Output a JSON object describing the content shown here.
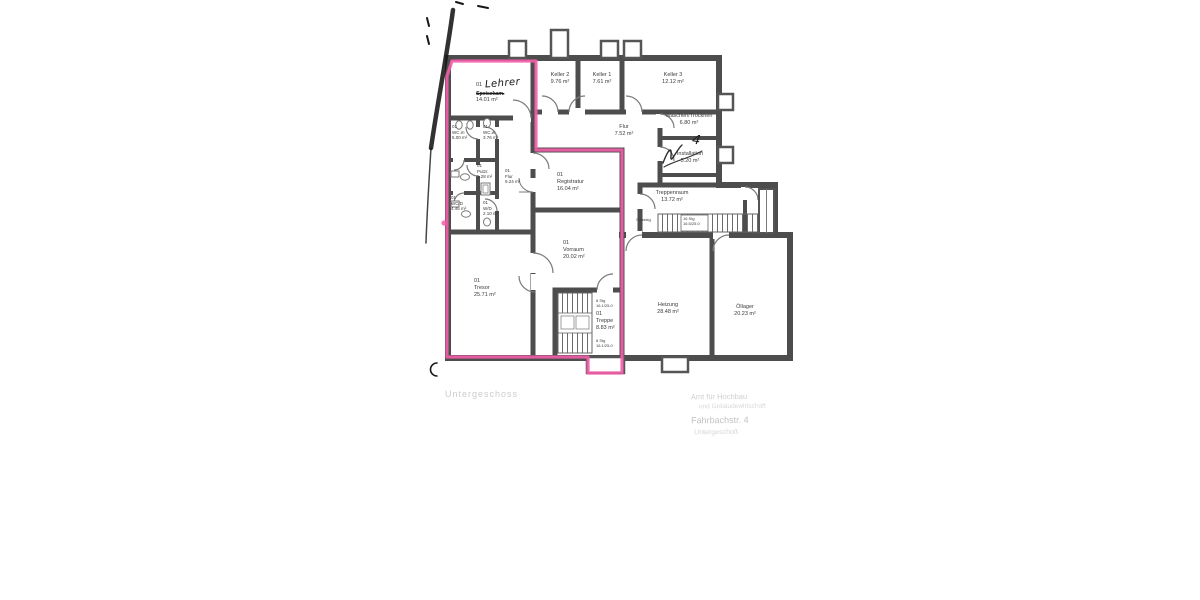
{
  "plan": {
    "floor_note": "Untergeschoss",
    "pen_note": "4"
  },
  "rooms": {
    "lehrer": {
      "num": "01",
      "handwritten": "Lehrer",
      "crossed_out": "Speisekam.",
      "area": "14.01 m²"
    },
    "keller2": {
      "name": "Keller 2",
      "area": "9.76 m²"
    },
    "keller1": {
      "name": "Keller 1",
      "area": "7.61 m²"
    },
    "keller3": {
      "name": "Keller 3",
      "area": "12.12 m²"
    },
    "waschen_trocknen": {
      "name": "Waschen/Trocknen",
      "area": "6.80 m²"
    },
    "flur_og": {
      "name": "Flur",
      "area": "7.52 m²"
    },
    "installation": {
      "name": "Installation",
      "area": "5.20 m²"
    },
    "treppenraum": {
      "name": "Treppenraum",
      "area": "13.72 m²"
    },
    "wc_m": {
      "num": "01",
      "name": "WC.m",
      "area": "5.00 m²"
    },
    "wc_w": {
      "num": "01",
      "name": "WC.w",
      "area": "3.76 m²"
    },
    "putzraum": {
      "num": "01",
      "name": "Putzr.",
      "area": "1.28 m²"
    },
    "flur_klein": {
      "num": "01",
      "name": "Flur",
      "area": "9.24 m²"
    },
    "wc_d": {
      "num": "01",
      "name": "WC/D",
      "area": "4.46 m²"
    },
    "w_d": {
      "num": "01",
      "name": "W/D",
      "area": "2.10 m²"
    },
    "registratur": {
      "num": "01",
      "name": "Registratur",
      "area": "16.04 m²"
    },
    "vorraum": {
      "num": "01",
      "name": "Vorraum",
      "area": "20.02 m²"
    },
    "tresor": {
      "num": "01",
      "name": "Tresor",
      "area": "25.71 m²"
    },
    "treppe": {
      "num": "01",
      "name": "Treppe",
      "area": "8.83 m²"
    },
    "heizung": {
      "name": "Heizung",
      "area": "28.48 m²"
    },
    "oellager": {
      "name": "Öllager",
      "area": "20.23 m²"
    }
  },
  "stair_labels": {
    "treppenraum_steps_line1": "16 Stg",
    "treppenraum_steps_line2": "16.5/25.0",
    "treppenraum_material": "Sandstg.",
    "lower_top_line1": "8 Stg",
    "lower_top_line2": "16.1/25.0",
    "lower_bottom_line1": "8 Stg",
    "lower_bottom_line2": "16.1/25.0"
  },
  "stamp": {
    "line1": "Amt für Hochbau",
    "line2": "und Gebäudewirtschaft",
    "line3": "Fahrbachstr. 4",
    "line4": "Untergeschoß"
  },
  "colors": {
    "wall": "#4d4d4d",
    "thin_line": "#7a7a7a",
    "highlight_pink": "#f25fa9",
    "ink": "#161616",
    "label_text": "#3a3a3a"
  }
}
